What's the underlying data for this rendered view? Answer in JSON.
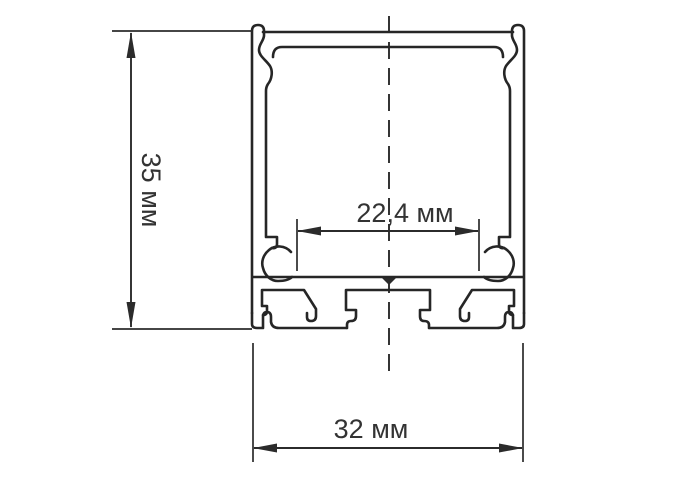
{
  "drawing": {
    "kind": "technical-cross-section",
    "subject": "aluminum LED profile cross-section with clip hooks, screw channels and mounting slots",
    "background_color": "#ffffff",
    "line_color": "#262626",
    "text_color": "#333333",
    "dimensions": {
      "height": {
        "label": "35 мм",
        "value": 35,
        "unit": "мм",
        "orientation": "vertical"
      },
      "inner_width": {
        "label": "22,4 мм",
        "value": 22.4,
        "unit": "мм",
        "orientation": "horizontal"
      },
      "outer_width": {
        "label": "32 мм",
        "value": 32,
        "unit": "мм",
        "orientation": "horizontal"
      }
    }
  }
}
